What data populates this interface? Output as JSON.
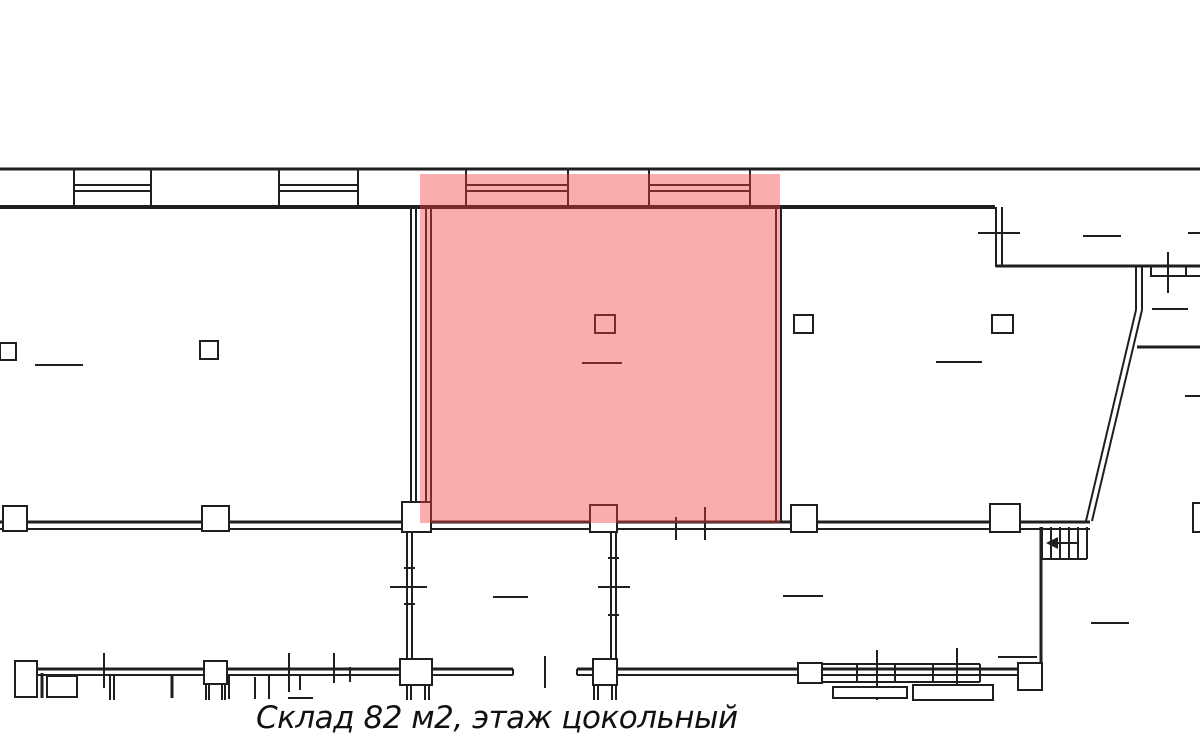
{
  "caption": {
    "text": "Склад 82 м2, этаж цокольный"
  },
  "highlight": {
    "x": 420,
    "y": 174,
    "w": 360,
    "h": 349,
    "color": "#f03c3c",
    "opacity": 0.42,
    "meaning": "highlighted warehouse unit"
  },
  "plan": {
    "stroke": "#1f1f1f",
    "background": "#ffffff",
    "lines": [
      [
        0,
        169,
        1200,
        169,
        3
      ],
      [
        0,
        207,
        995,
        207,
        4
      ],
      [
        0,
        522,
        1090,
        522,
        3
      ],
      [
        0,
        529,
        1090,
        529,
        2
      ],
      [
        74,
        169,
        74,
        207,
        2
      ],
      [
        151,
        169,
        151,
        207,
        2
      ],
      [
        74,
        185,
        151,
        185,
        2
      ],
      [
        74,
        191,
        151,
        191,
        2
      ],
      [
        279,
        169,
        279,
        207,
        2
      ],
      [
        358,
        169,
        358,
        207,
        2
      ],
      [
        279,
        185,
        358,
        185,
        2
      ],
      [
        279,
        191,
        358,
        191,
        2
      ],
      [
        466,
        169,
        466,
        207,
        2
      ],
      [
        568,
        169,
        568,
        207,
        2
      ],
      [
        466,
        185,
        568,
        185,
        2
      ],
      [
        466,
        191,
        568,
        191,
        2
      ],
      [
        649,
        169,
        649,
        207,
        2
      ],
      [
        750,
        169,
        750,
        207,
        2
      ],
      [
        649,
        185,
        750,
        185,
        2
      ],
      [
        649,
        191,
        750,
        191,
        2
      ],
      [
        411,
        207,
        411,
        522,
        2
      ],
      [
        416,
        207,
        416,
        522,
        2
      ],
      [
        35,
        365,
        83,
        365,
        2
      ],
      [
        426,
        207,
        426,
        522,
        2
      ],
      [
        431,
        207,
        431,
        522,
        2
      ],
      [
        776,
        207,
        776,
        522,
        2
      ],
      [
        781,
        207,
        781,
        522,
        2
      ],
      [
        582,
        363,
        622,
        363,
        2
      ],
      [
        676,
        517,
        676,
        540,
        2
      ],
      [
        705,
        507,
        705,
        540,
        2
      ],
      [
        996,
        207,
        996,
        267,
        2
      ],
      [
        1002,
        207,
        1002,
        267,
        2
      ],
      [
        978,
        233,
        1020,
        233,
        2
      ],
      [
        996,
        266,
        1200,
        266,
        3
      ],
      [
        1150,
        276,
        1200,
        276,
        2
      ],
      [
        1151,
        266,
        1151,
        276,
        2
      ],
      [
        1186,
        266,
        1186,
        276,
        2
      ],
      [
        1168,
        252,
        1168,
        293,
        2
      ],
      [
        1083,
        236,
        1121,
        236,
        2
      ],
      [
        1188,
        233,
        1200,
        233,
        2
      ],
      [
        1136,
        267,
        1136,
        310,
        2
      ],
      [
        1142,
        267,
        1142,
        310,
        2
      ],
      [
        1136,
        310,
        1086,
        521,
        2
      ],
      [
        1142,
        310,
        1092,
        521,
        2
      ],
      [
        1137,
        347,
        1200,
        347,
        3
      ],
      [
        1152,
        309,
        1188,
        309,
        2
      ],
      [
        1185,
        396,
        1200,
        396,
        2
      ],
      [
        936,
        362,
        982,
        362,
        2
      ],
      [
        1042,
        527,
        1042,
        559,
        2
      ],
      [
        1051,
        527,
        1051,
        559,
        2
      ],
      [
        1060,
        527,
        1060,
        559,
        2
      ],
      [
        1069,
        527,
        1069,
        559,
        2
      ],
      [
        1078,
        527,
        1078,
        559,
        2
      ],
      [
        1087,
        527,
        1087,
        559,
        2
      ],
      [
        1042,
        559,
        1087,
        559,
        2
      ],
      [
        1053,
        543,
        1078,
        543,
        2
      ],
      [
        1041,
        527,
        1041,
        668,
        3
      ],
      [
        407,
        530,
        407,
        660,
        2
      ],
      [
        412,
        530,
        412,
        660,
        2
      ],
      [
        404,
        568,
        415,
        568,
        2
      ],
      [
        404,
        604,
        415,
        604,
        2
      ],
      [
        390,
        587,
        427,
        587,
        2
      ],
      [
        611,
        532,
        611,
        660,
        2
      ],
      [
        616,
        532,
        616,
        660,
        2
      ],
      [
        608,
        558,
        619,
        558,
        2
      ],
      [
        608,
        615,
        619,
        615,
        2
      ],
      [
        598,
        587,
        630,
        587,
        2
      ],
      [
        15,
        669,
        513,
        669,
        3
      ],
      [
        15,
        675,
        513,
        675,
        2
      ],
      [
        513,
        669,
        513,
        675,
        2
      ],
      [
        577,
        669,
        577,
        675,
        2
      ],
      [
        577,
        669,
        1042,
        669,
        3
      ],
      [
        577,
        675,
        1042,
        675,
        2
      ],
      [
        545,
        656,
        545,
        688,
        2
      ],
      [
        42,
        673,
        42,
        698,
        3
      ],
      [
        50,
        686,
        73,
        686,
        2
      ],
      [
        57,
        676,
        57,
        686,
        2
      ],
      [
        52,
        693,
        62,
        693,
        2
      ],
      [
        66,
        675,
        66,
        698,
        2
      ],
      [
        71,
        675,
        71,
        698,
        2
      ],
      [
        104,
        653,
        104,
        688,
        2
      ],
      [
        110,
        675,
        110,
        700,
        2
      ],
      [
        114,
        675,
        114,
        700,
        2
      ],
      [
        172,
        675,
        172,
        698,
        3
      ],
      [
        206,
        684,
        206,
        700,
        2
      ],
      [
        209,
        684,
        209,
        700,
        2
      ],
      [
        222,
        684,
        222,
        700,
        2
      ],
      [
        225,
        684,
        225,
        700,
        2
      ],
      [
        229,
        675,
        229,
        699,
        2
      ],
      [
        255,
        677,
        255,
        699,
        2
      ],
      [
        269,
        675,
        269,
        699,
        2
      ],
      [
        289,
        653,
        289,
        692,
        2
      ],
      [
        334,
        653,
        334,
        683,
        2
      ],
      [
        300,
        675,
        300,
        690,
        2
      ],
      [
        288,
        698,
        313,
        698,
        2
      ],
      [
        350,
        667,
        350,
        682,
        2
      ],
      [
        407,
        685,
        407,
        700,
        2
      ],
      [
        411,
        685,
        411,
        700,
        2
      ],
      [
        425,
        685,
        425,
        700,
        2
      ],
      [
        429,
        685,
        429,
        700,
        2
      ],
      [
        594,
        685,
        594,
        700,
        2
      ],
      [
        598,
        685,
        598,
        700,
        2
      ],
      [
        612,
        685,
        612,
        700,
        2
      ],
      [
        616,
        685,
        616,
        700,
        2
      ],
      [
        822,
        664,
        980,
        664,
        2
      ],
      [
        822,
        682,
        980,
        682,
        2
      ],
      [
        857,
        664,
        857,
        682,
        2
      ],
      [
        895,
        664,
        895,
        682,
        2
      ],
      [
        933,
        664,
        933,
        682,
        2
      ],
      [
        957,
        664,
        957,
        682,
        2
      ],
      [
        980,
        664,
        980,
        682,
        2
      ],
      [
        998,
        657,
        1037,
        657,
        2
      ],
      [
        877,
        650,
        877,
        700,
        2
      ],
      [
        957,
        648,
        957,
        700,
        2
      ],
      [
        493,
        597,
        528,
        597,
        2
      ],
      [
        783,
        596,
        823,
        596,
        2
      ],
      [
        1091,
        623,
        1129,
        623,
        2
      ]
    ],
    "boxes": [
      [
        0,
        343,
        16,
        17
      ],
      [
        200,
        341,
        18,
        18
      ],
      [
        3,
        506,
        24,
        25
      ],
      [
        202,
        506,
        27,
        25
      ],
      [
        595,
        315,
        20,
        18
      ],
      [
        794,
        315,
        19,
        18
      ],
      [
        992,
        315,
        21,
        18
      ],
      [
        402,
        502,
        29,
        30
      ],
      [
        590,
        505,
        27,
        27
      ],
      [
        791,
        505,
        26,
        27
      ],
      [
        990,
        504,
        30,
        28
      ],
      [
        1193,
        503,
        12,
        29
      ],
      [
        400,
        659,
        32,
        26
      ],
      [
        593,
        659,
        24,
        26
      ],
      [
        15,
        661,
        22,
        36
      ],
      [
        47,
        676,
        30,
        21
      ],
      [
        204,
        661,
        23,
        23
      ],
      [
        798,
        663,
        24,
        20
      ],
      [
        1018,
        663,
        24,
        27
      ],
      [
        833,
        687,
        74,
        11
      ],
      [
        913,
        685,
        80,
        15
      ]
    ],
    "polygons": [
      [
        [
          1046,
          543
        ],
        [
          1058,
          537
        ],
        [
          1058,
          549
        ]
      ]
    ]
  }
}
